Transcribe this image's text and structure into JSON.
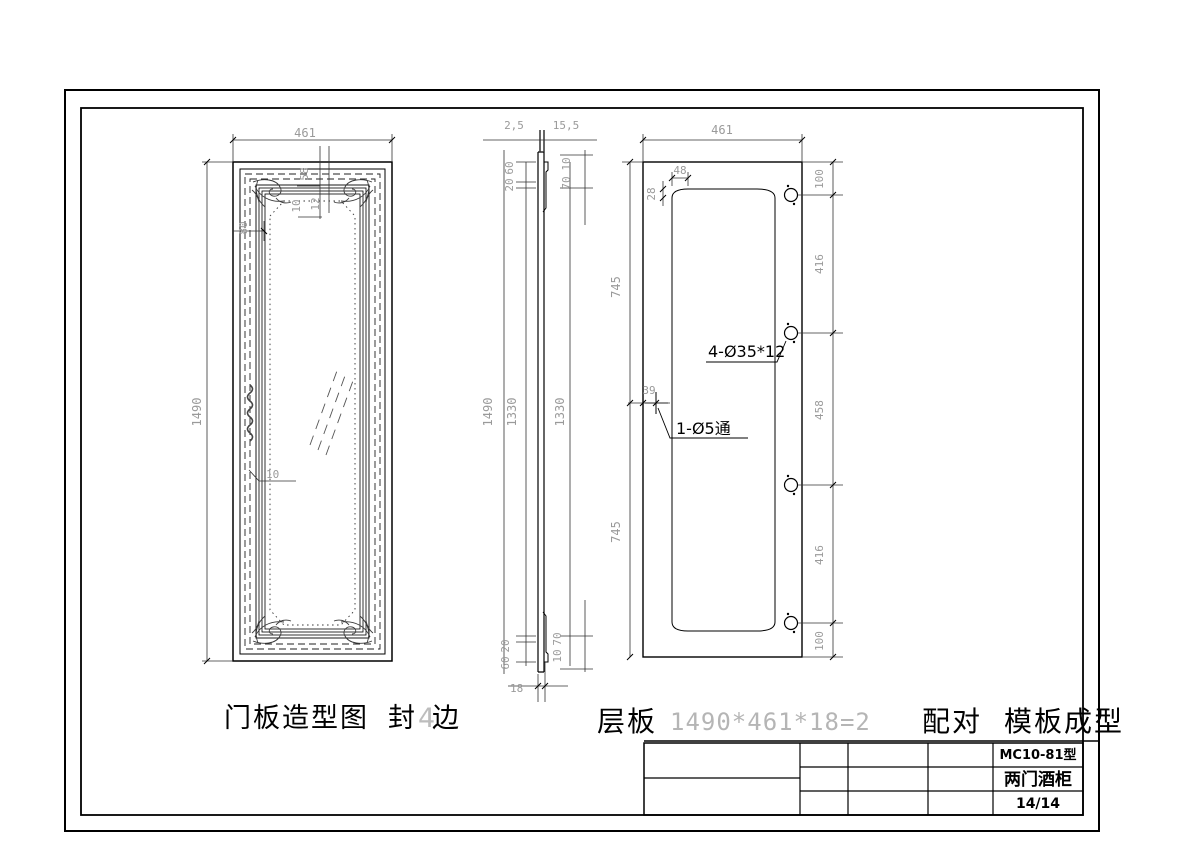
{
  "colors": {
    "line": "#000000",
    "dim_line": "#333333",
    "dim_text": "#9a9a9a",
    "label_text": "#000000",
    "gray_text": "#b5b5b5"
  },
  "front_view": {
    "title_part1": "门板造型图",
    "title_part2": "封",
    "title_part3": "4",
    "title_part4": "边",
    "dims": {
      "width": "461",
      "height": "1490",
      "edge_80": "80",
      "detail_58": "58",
      "detail_10": "10",
      "detail_12": "12",
      "mid_10": "10"
    }
  },
  "side_view": {
    "dims": {
      "top_left": "2,5",
      "top_right": "15,5",
      "tl_chain_60": "60",
      "tl_chain_20": "20",
      "tr_chain_10": "10",
      "tr_chain_70": "70",
      "height_total": "1490",
      "height_inner_left": "1330",
      "height_inner_right": "1330",
      "bl_chain_20": "20",
      "bl_chain_60": "60",
      "br_chain_70": "70",
      "br_chain_10": "10",
      "thickness": "18"
    }
  },
  "drill_view": {
    "dims": {
      "width": "461",
      "arc_width": "48",
      "arc_depth": "28",
      "half_top": "745",
      "half_bottom": "745",
      "hole_offset": "39",
      "chain_100_top": "100",
      "chain_416_top": "416",
      "chain_458": "458",
      "chain_416_bottom": "416",
      "chain_100_bottom": "100"
    },
    "labels": {
      "large_holes": "4-Ø35*12",
      "small_hole": "1-Ø5通"
    }
  },
  "footer": {
    "part_name": "层板",
    "size_formula": "1490*461*18=2",
    "pairing": "配对",
    "molding": "模板成型"
  },
  "title_block": {
    "model": "MC10-81型",
    "product": "两门酒柜",
    "page": "14/14"
  }
}
